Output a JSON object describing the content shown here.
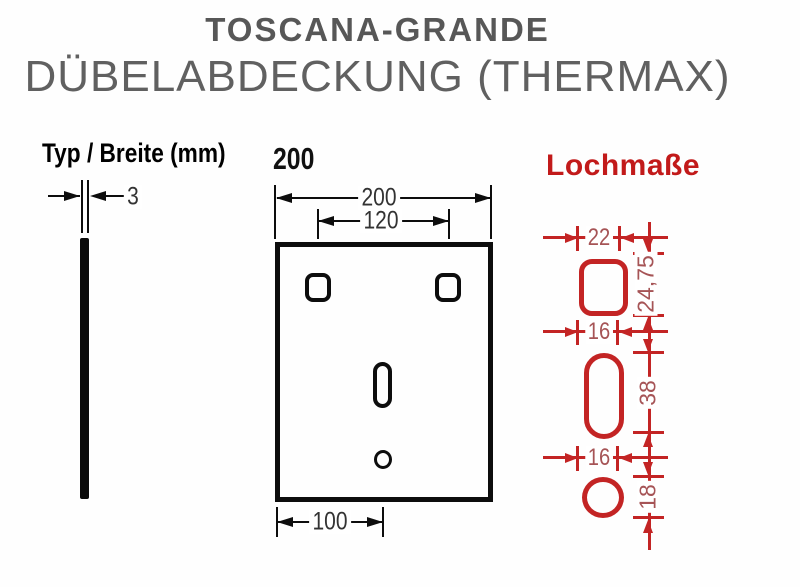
{
  "title": {
    "line1": "TOSCANA-GRANDE",
    "line2": "DÜBELABDECKUNG (THERMAX)"
  },
  "left_diagram": {
    "heading": "Typ / Breite (mm)",
    "thickness": "3"
  },
  "front_diagram": {
    "type_label": "200",
    "width": "200",
    "top_hole_spacing": "120",
    "bottom_hole_offset": "100"
  },
  "hole_diagram": {
    "heading": "Lochmaße",
    "square_hole": {
      "width": "22",
      "height": "24,75"
    },
    "slot_hole": {
      "width": "16",
      "height": "38"
    },
    "round_hole": {
      "width": "16",
      "height": "18"
    }
  },
  "colors": {
    "drawing_black": "#0d0d0d",
    "drawing_red": "#c32424",
    "red_number_text": "#a65456",
    "red_heading": "#c21a1a",
    "title_gray": "#575757"
  }
}
